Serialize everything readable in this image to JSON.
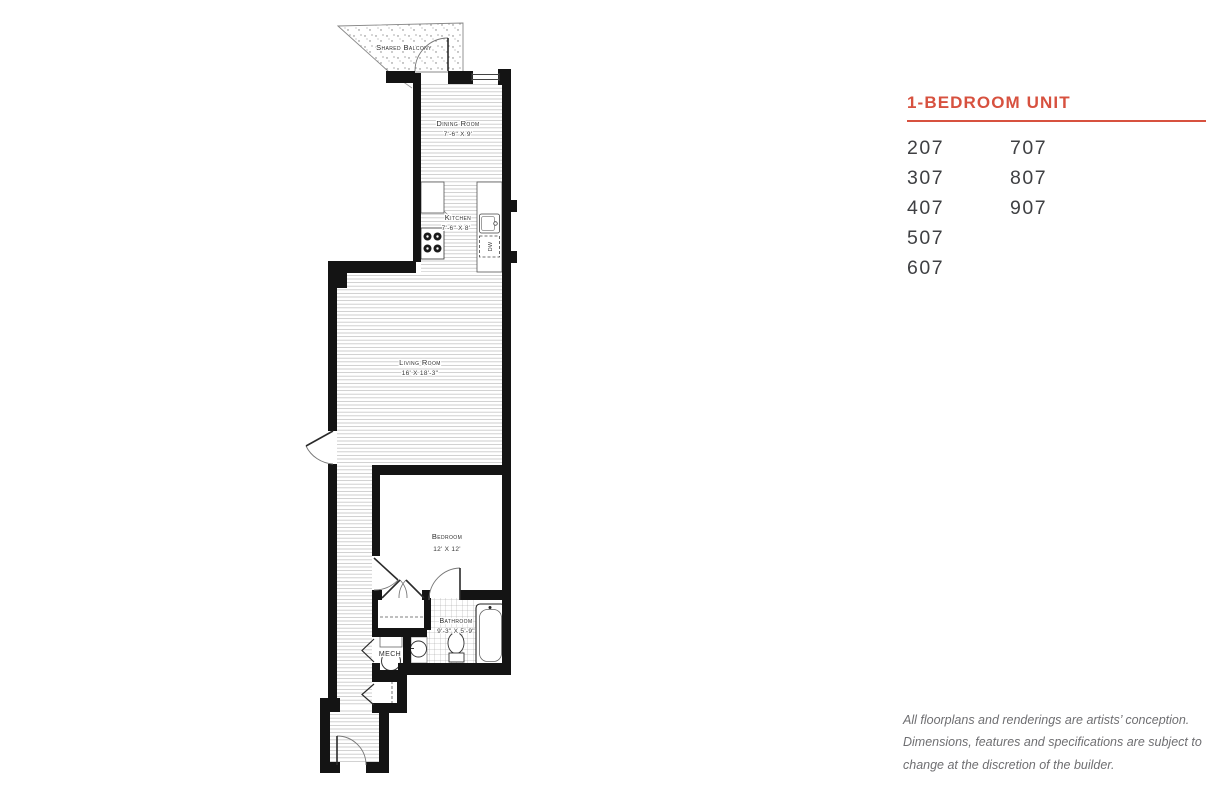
{
  "panel": {
    "heading": "1-BEDROOM UNIT",
    "accent_color": "#d7513f",
    "units_col1": [
      "207",
      "307",
      "407",
      "507",
      "607"
    ],
    "units_col2": [
      "707",
      "807",
      "907"
    ]
  },
  "disclaimer": {
    "line1": "All floorplans and renderings are artists’ conception.",
    "line2": "Dimensions, features and specifications are subject to",
    "line3": "change at the discretion of the builder."
  },
  "floorplan": {
    "balcony_label": "Shared Balcony",
    "dining_label": "Dining Room",
    "dining_dims": "7'-6\" X 9'",
    "kitchen_label": "Kitchen",
    "kitchen_dims": "7'-6\" X 8'",
    "living_label": "Living Room",
    "living_dims": "16' X 18'-3\"",
    "bedroom_label": "Bedroom",
    "bedroom_dims": "12' X 12'",
    "bathroom_label": "Bathroom",
    "bathroom_dims": "9'-3\" X 5'-9\"",
    "mech_label": "MECH",
    "dw_label": "DW"
  }
}
